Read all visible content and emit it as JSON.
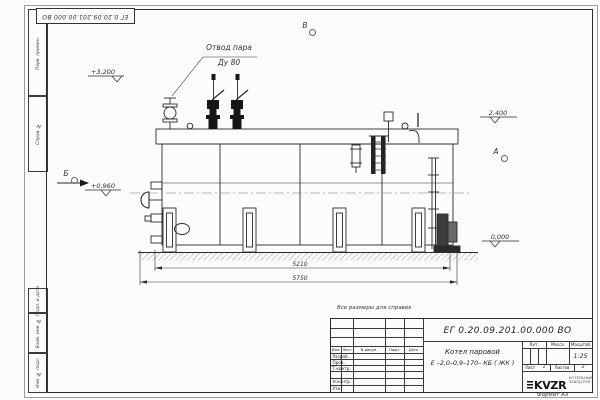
{
  "sheet": {
    "stamp_doc_number": "ЕГ 0.20.09.201.00.000  ВО",
    "reference_note": "Все размеры для справок",
    "format_note": "Формат  А3"
  },
  "margins": {
    "top_cells": [
      "Перв. примен.",
      "Справ. №"
    ],
    "bottom_cells": [
      "Подп. и дата",
      "Взам. инв. №",
      "Инв. № подл."
    ]
  },
  "drawing": {
    "steam_outlet_line1": "Отвод пара",
    "steam_outlet_line2": "Ду 80",
    "elev_top": "+3,200",
    "elev_right_top": "2,400",
    "elev_left": "+0,960",
    "elev_ground": "0,000",
    "dim_inner": "5210",
    "dim_outer": "5750",
    "view_top": "В",
    "view_right": "А",
    "view_left": "Б"
  },
  "title_block": {
    "doc_number": "ЕГ 0.20.09.201.00.000  ВО",
    "product_name_line1": "Котел паровой",
    "product_name_line2": "Е –2,0–0,9–170– КБ ( ЖК )",
    "col_headers": [
      "Изм.",
      "Лист",
      "N докум.",
      "Подп.",
      "Дата"
    ],
    "sign_rows": [
      "Разраб.",
      "Пров.",
      "Т.контр.",
      "Н.контр.",
      "Утв."
    ],
    "lit_header": "Лит.",
    "mass_header": "Масса",
    "scale_header": "Масштаб",
    "scale_value": "1:25",
    "sheet_label": "Лист",
    "sheet_value": "1",
    "sheets_label": "Листов",
    "sheets_value": "2",
    "logo_text": "KVZR",
    "logo_caption_line1": "КОТЕЛЬНЫЙ",
    "logo_caption_line2": "ЗАВОД РЭП"
  }
}
